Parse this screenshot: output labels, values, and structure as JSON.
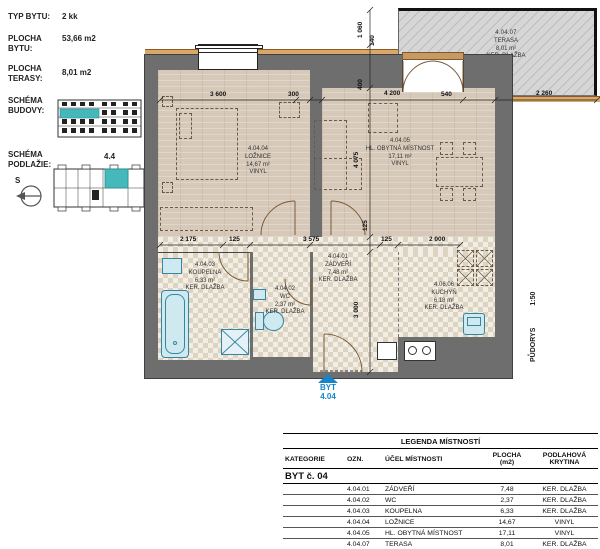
{
  "info": {
    "typ_bytu_label": "TYP BYTU:",
    "typ_bytu": "2 kk",
    "plocha_bytu_label": "PLOCHA\nBYTU:",
    "plocha_bytu": "53,66 m2",
    "plocha_terasy_label": "PLOCHA\nTERASY:",
    "plocha_terasy": "8,01 m2",
    "schema_budovy_label": "SCHÉMA\nBUDOVY:",
    "schema_podlazie_label": "SCHÉMA\nPODLAŽIE:",
    "unit_ref": "4.4",
    "compass_letter": "S"
  },
  "plan": {
    "rooms": [
      {
        "id": "4.04.04",
        "name": "LOŽNICE",
        "area": "14,67 m²",
        "floor": "VINYL"
      },
      {
        "id": "4.04.05",
        "name": "HL. OBYTNÁ MÍSTNOST",
        "area": "17,11 m²",
        "floor": "VINYL"
      },
      {
        "id": "4.04.07",
        "name": "TERASA",
        "area": "8,01 m²",
        "floor": "KER. DLAŽBA"
      },
      {
        "id": "4.04.03",
        "name": "KOUPELNA",
        "area": "6,33 m²",
        "floor": "KER. DLAŽBA"
      },
      {
        "id": "4.04.02",
        "name": "WC",
        "area": "2,37 m²",
        "floor": "KER. DLAŽBA"
      },
      {
        "id": "4.04.01",
        "name": "ZÁDVEŘÍ",
        "area": "7,48 m²",
        "floor": "KER. DLAŽBA"
      },
      {
        "id": "4.06.06",
        "name": "KUCHYŇ",
        "area": "6,18 m²",
        "floor": "KER. DLAŽBA"
      }
    ],
    "dims": {
      "d3600": "3 600",
      "d300": "300",
      "d4200": "4 200",
      "d540": "540",
      "d2260": "2 260",
      "d2175": "2 175",
      "d125a": "125",
      "d3575": "3 575",
      "d125b": "125",
      "d2000": "2 000",
      "d1060": "1 060",
      "d140": "140",
      "d400": "400",
      "d4075": "4 075",
      "d125c": "125",
      "d3000": "3 000"
    },
    "entrance": {
      "label": "BYT",
      "number": "4.04"
    },
    "drawing": {
      "title": "PŮDORYS",
      "scale": "1:50"
    }
  },
  "legend": {
    "title": "LEGENDA MÍSTNOSTÍ",
    "headers": [
      "KATEGORIE",
      "OZN.",
      "ÚČEL MÍSTNOSTI",
      "PLOCHA (m2)",
      "PODLAHOVÁ KRYTINA"
    ],
    "category": "BYT č. 04",
    "rows": [
      {
        "ozn": "4.04.01",
        "ucel": "ZÁDVEŘÍ",
        "plocha": "7,48",
        "krytina": "KER. DLAŽBA"
      },
      {
        "ozn": "4.04.02",
        "ucel": "WC",
        "plocha": "2,37",
        "krytina": "KER. DLAŽBA"
      },
      {
        "ozn": "4.04.03",
        "ucel": "KOUPELNA",
        "plocha": "6,33",
        "krytina": "KER. DLAŽBA"
      },
      {
        "ozn": "4.04.04",
        "ucel": "LOŽNICE",
        "plocha": "14,67",
        "krytina": "VINYL"
      },
      {
        "ozn": "4.04.05",
        "ucel": "HL. OBYTNÁ MÍSTNOST",
        "plocha": "17,11",
        "krytina": "VINYL"
      },
      {
        "ozn": "4.04.07",
        "ucel": "TERASA",
        "plocha": "8,01",
        "krytina": "KER. DLAŽBA"
      },
      {
        "ozn": "4.06.06",
        "ucel": "KUCHYŇ",
        "plocha": "6,18",
        "krytina": "KER. DLAŽBA"
      }
    ]
  },
  "colors": {
    "wall": "#6e6e6e",
    "wood_floor": "#d7c9b9",
    "tile_floor": "#f2eee5",
    "terrace": "#d6d6d6",
    "facade": "#d9a868",
    "fixture_fill": "#cfe9f0",
    "fixture_stroke": "#39859e",
    "schema_highlight": "#45b8bc",
    "entrance_blue": "#1786c8"
  }
}
